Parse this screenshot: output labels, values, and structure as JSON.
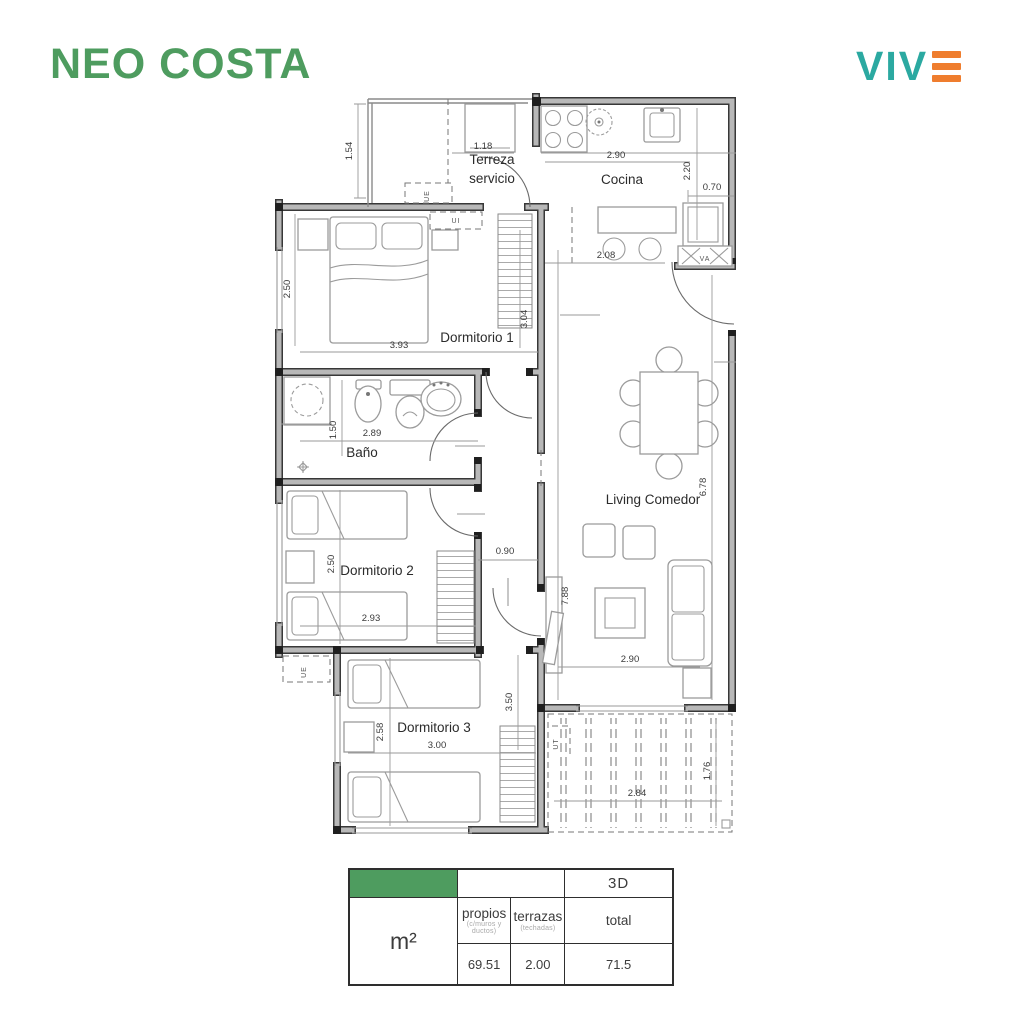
{
  "header": {
    "title": "NEO COSTA",
    "logo_text": "VIV"
  },
  "colors": {
    "green": "#4E9C5F",
    "teal": "#2BA9A1",
    "orange": "#EF7D2E"
  },
  "plan": {
    "rooms": {
      "terraza_1": "Terreza",
      "terraza_2": "servicio",
      "cocina": "Cocina",
      "dorm1": "Dormitorio 1",
      "bano": "Baño",
      "dorm2": "Dormitorio 2",
      "living": "Living Comedor",
      "dorm3": "Dormitorio 3"
    },
    "dims": {
      "terraza_h": "1.54",
      "terraza_w": "1.18",
      "cocina_w": "2.90",
      "cocina_h": "2.20",
      "shaft_w": "0.70",
      "bar_w": "2.08",
      "dorm1_h": "2.50",
      "dorm1_w": "3.93",
      "dorm1_h2": "3.04",
      "bano_h": "1.50",
      "bano_w": "2.89",
      "dorm2_h": "2.50",
      "dorm2_w": "2.93",
      "hall_w": "0.90",
      "living_h_right": "6.78",
      "living_h_left": "7.88",
      "living_w": "2.90",
      "dorm3_h_right": "3.50",
      "dorm3_h_left": "2.58",
      "dorm3_w": "3.00",
      "terrace_w": "2.84",
      "terrace_h": "1.76"
    },
    "tags": {
      "ue_top": "UE",
      "ui": "UI",
      "ue_bottom": "UE",
      "ut": "UT",
      "va": "VA"
    }
  },
  "table": {
    "badge": "3D",
    "unit": "m²",
    "propios_title": "propios",
    "propios_sub": "(c/muros y ductos)",
    "terrazas_title": "terrazas",
    "terrazas_sub": "(techadas)",
    "total_title": "total",
    "propios_value": "69.51",
    "terrazas_value": "2.00",
    "total_value": "71.5"
  }
}
